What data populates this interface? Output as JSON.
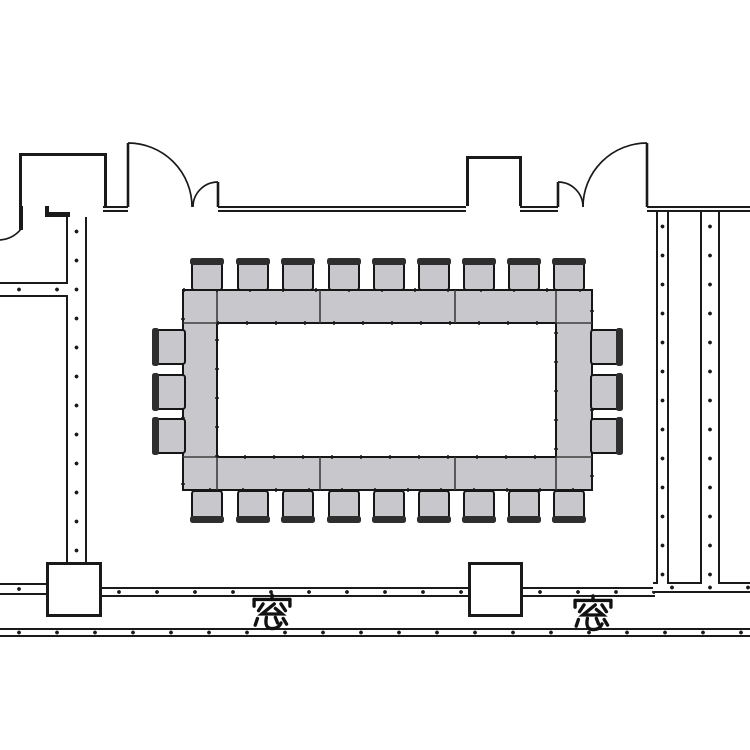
{
  "page": {
    "background": "#ffffff",
    "description": "conference room floor plan"
  },
  "labels": {
    "window": "窓"
  },
  "colors": {
    "wall": "#1a1a1a",
    "furniture_fill": "#c8c8cc",
    "furniture_stroke": "#161616",
    "divider": "#3d3d3d",
    "chair_back": "#2e2e2e",
    "text": "#111111",
    "background": "#ffffff"
  },
  "floorplan": {
    "walls_solid": [
      {
        "name": "top-wall-left-segment",
        "x": 103,
        "y": 206,
        "w": 25,
        "h": 6,
        "style": "double"
      },
      {
        "name": "top-wall-center-segment",
        "x": 218,
        "y": 206,
        "w": 248,
        "h": 6,
        "style": "double"
      },
      {
        "name": "top-wall-right-inner-segment",
        "x": 520,
        "y": 206,
        "w": 38,
        "h": 6,
        "style": "double"
      },
      {
        "name": "top-wall-right-segment",
        "x": 647,
        "y": 206,
        "w": 103,
        "h": 6,
        "style": "double"
      },
      {
        "name": "alcove-inner-divider",
        "x": 45,
        "y": 158,
        "w": 4,
        "h": 54,
        "style": "plain"
      },
      {
        "name": "alcove-connector-wall",
        "x": 45,
        "y": 212,
        "w": 25,
        "h": 5,
        "style": "plain"
      },
      {
        "name": "alcove-left-tail-wall",
        "x": 19,
        "y": 204,
        "w": 4,
        "h": 26,
        "style": "plain"
      }
    ],
    "walls_double": [
      {
        "name": "left-corridor-wall-vertical",
        "x": 66,
        "y": 217,
        "w": 21,
        "h": 347,
        "dir": "v"
      },
      {
        "name": "left-partition-wall",
        "x": 0,
        "y": 282,
        "w": 68,
        "h": 15,
        "dir": "h"
      },
      {
        "name": "left-bottom-wall",
        "x": 0,
        "y": 583,
        "w": 48,
        "h": 12,
        "dir": "h"
      },
      {
        "name": "bottom-wall-west",
        "x": 100,
        "y": 587,
        "w": 370,
        "h": 10,
        "dir": "h"
      },
      {
        "name": "bottom-wall-east",
        "x": 521,
        "y": 587,
        "w": 134,
        "h": 10,
        "dir": "h"
      },
      {
        "name": "bottom-wall-right",
        "x": 653,
        "y": 582,
        "w": 97,
        "h": 11,
        "dir": "h"
      },
      {
        "name": "right-corridor-wall-inner",
        "x": 656,
        "y": 212,
        "w": 13,
        "h": 372,
        "dir": "v"
      },
      {
        "name": "right-corridor-wall-outer",
        "x": 700,
        "y": 212,
        "w": 20,
        "h": 372,
        "dir": "v"
      },
      {
        "name": "window-wall-band",
        "x": 0,
        "y": 628,
        "w": 750,
        "h": 9,
        "dir": "h"
      }
    ],
    "outline_boxes": [
      {
        "name": "top-left-alcove",
        "x": 19,
        "y": 153,
        "w": 88,
        "h": 53,
        "open": "bottom"
      },
      {
        "name": "top-duct-niche",
        "x": 466,
        "y": 156,
        "w": 56,
        "h": 50,
        "open": "bottom"
      },
      {
        "name": "column-left",
        "x": 46,
        "y": 562,
        "w": 56,
        "h": 55
      },
      {
        "name": "column-middle",
        "x": 468,
        "y": 562,
        "w": 55,
        "h": 55
      }
    ],
    "door_leaves": [
      {
        "name": "door-left-large-leaf",
        "x1": 128,
        "y1": 207,
        "x2": 128,
        "y2": 143
      },
      {
        "name": "door-left-small-leaf",
        "x1": 218,
        "y1": 207,
        "x2": 218,
        "y2": 182
      },
      {
        "name": "door-right-large-leaf",
        "x1": 647,
        "y1": 207,
        "x2": 647,
        "y2": 143
      },
      {
        "name": "door-right-small-leaf",
        "x1": 558,
        "y1": 207,
        "x2": 558,
        "y2": 182
      }
    ],
    "door_arcs": [
      {
        "name": "door-left-large-swing",
        "d": "M128,143 A64,64 0 0 1 192,207"
      },
      {
        "name": "door-left-small-swing",
        "d": "M218,182 A25,25 0 0 0 193,207"
      },
      {
        "name": "door-right-large-swing",
        "d": "M647,143 A64,64 0 0 0 583,207"
      },
      {
        "name": "door-right-small-swing",
        "d": "M558,182 A25,25 0 0 1 583,207"
      },
      {
        "name": "left-edge-wall-curve",
        "d": "M21,229 Q13,239 0,240"
      }
    ],
    "table": {
      "outer": {
        "x": 183,
        "y": 290,
        "w": 409,
        "h": 200
      },
      "inner": {
        "x": 217,
        "y": 323,
        "w": 339,
        "h": 134
      },
      "dividers": [
        {
          "x1": 320,
          "y1": 290,
          "x2": 320,
          "y2": 323
        },
        {
          "x1": 455,
          "y1": 290,
          "x2": 455,
          "y2": 323
        },
        {
          "x1": 217,
          "y1": 290,
          "x2": 217,
          "y2": 323
        },
        {
          "x1": 556,
          "y1": 290,
          "x2": 556,
          "y2": 323
        },
        {
          "x1": 320,
          "y1": 457,
          "x2": 320,
          "y2": 490
        },
        {
          "x1": 455,
          "y1": 457,
          "x2": 455,
          "y2": 490
        },
        {
          "x1": 217,
          "y1": 457,
          "x2": 217,
          "y2": 490
        },
        {
          "x1": 556,
          "y1": 457,
          "x2": 556,
          "y2": 490
        },
        {
          "x1": 183,
          "y1": 323,
          "x2": 217,
          "y2": 323
        },
        {
          "x1": 556,
          "y1": 323,
          "x2": 592,
          "y2": 323
        },
        {
          "x1": 183,
          "y1": 457,
          "x2": 217,
          "y2": 457
        },
        {
          "x1": 556,
          "y1": 457,
          "x2": 592,
          "y2": 457
        }
      ]
    },
    "chair_size": {
      "horizontal": {
        "w": 34,
        "h": 32,
        "back": 7
      },
      "vertical": {
        "w": 33,
        "h": 38,
        "back": 7
      }
    },
    "chairs": [
      {
        "side": "top",
        "x": 190,
        "y": 258
      },
      {
        "side": "top",
        "x": 236,
        "y": 258
      },
      {
        "side": "top",
        "x": 281,
        "y": 258
      },
      {
        "side": "top",
        "x": 327,
        "y": 258
      },
      {
        "side": "top",
        "x": 372,
        "y": 258
      },
      {
        "side": "top",
        "x": 417,
        "y": 258
      },
      {
        "side": "top",
        "x": 462,
        "y": 258
      },
      {
        "side": "top",
        "x": 507,
        "y": 258
      },
      {
        "side": "top",
        "x": 552,
        "y": 258
      },
      {
        "side": "bottom",
        "x": 190,
        "y": 491
      },
      {
        "side": "bottom",
        "x": 236,
        "y": 491
      },
      {
        "side": "bottom",
        "x": 281,
        "y": 491
      },
      {
        "side": "bottom",
        "x": 327,
        "y": 491
      },
      {
        "side": "bottom",
        "x": 372,
        "y": 491
      },
      {
        "side": "bottom",
        "x": 417,
        "y": 491
      },
      {
        "side": "bottom",
        "x": 462,
        "y": 491
      },
      {
        "side": "bottom",
        "x": 507,
        "y": 491
      },
      {
        "side": "bottom",
        "x": 552,
        "y": 491
      },
      {
        "side": "left",
        "x": 152,
        "y": 328
      },
      {
        "side": "left",
        "x": 152,
        "y": 373
      },
      {
        "side": "left",
        "x": 152,
        "y": 417
      },
      {
        "side": "right",
        "x": 590,
        "y": 328
      },
      {
        "side": "right",
        "x": 590,
        "y": 373
      },
      {
        "side": "right",
        "x": 590,
        "y": 417
      }
    ],
    "window_labels": [
      {
        "name": "window-label-left",
        "cx": 272,
        "cy": 614
      },
      {
        "name": "window-label-right",
        "cx": 593,
        "cy": 615
      }
    ]
  }
}
